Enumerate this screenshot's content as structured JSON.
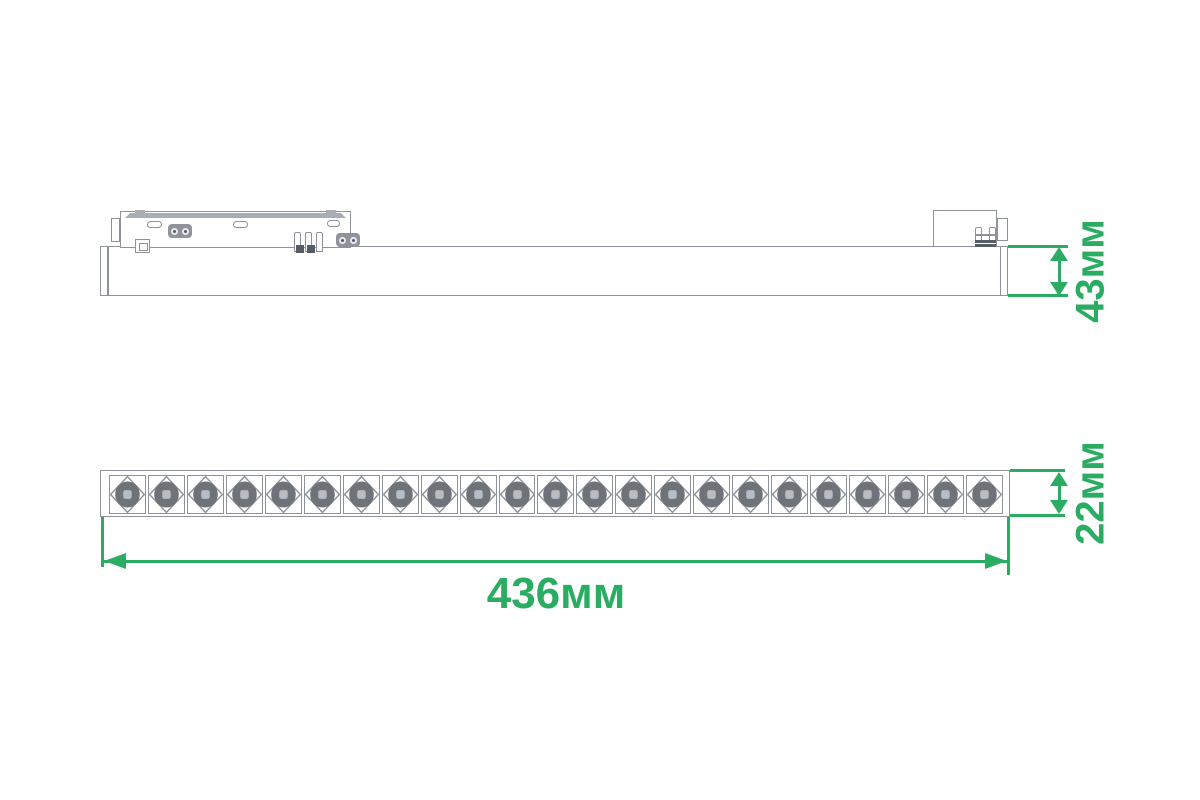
{
  "colors": {
    "accent_green": "#2aad62",
    "line_gray": "#8e939b",
    "fill_gray": "#a9adb4",
    "connector_gray": "#8f949c",
    "detail_dark": "#565c64",
    "led_ring": "#6e737a",
    "led_center": "#b9bcc1"
  },
  "side_view": {
    "dimension_height": {
      "label": "43мм"
    }
  },
  "front_view": {
    "led_count": 23,
    "dimension_depth": {
      "label": "22мм"
    },
    "dimension_length": {
      "label": "436мм"
    }
  }
}
